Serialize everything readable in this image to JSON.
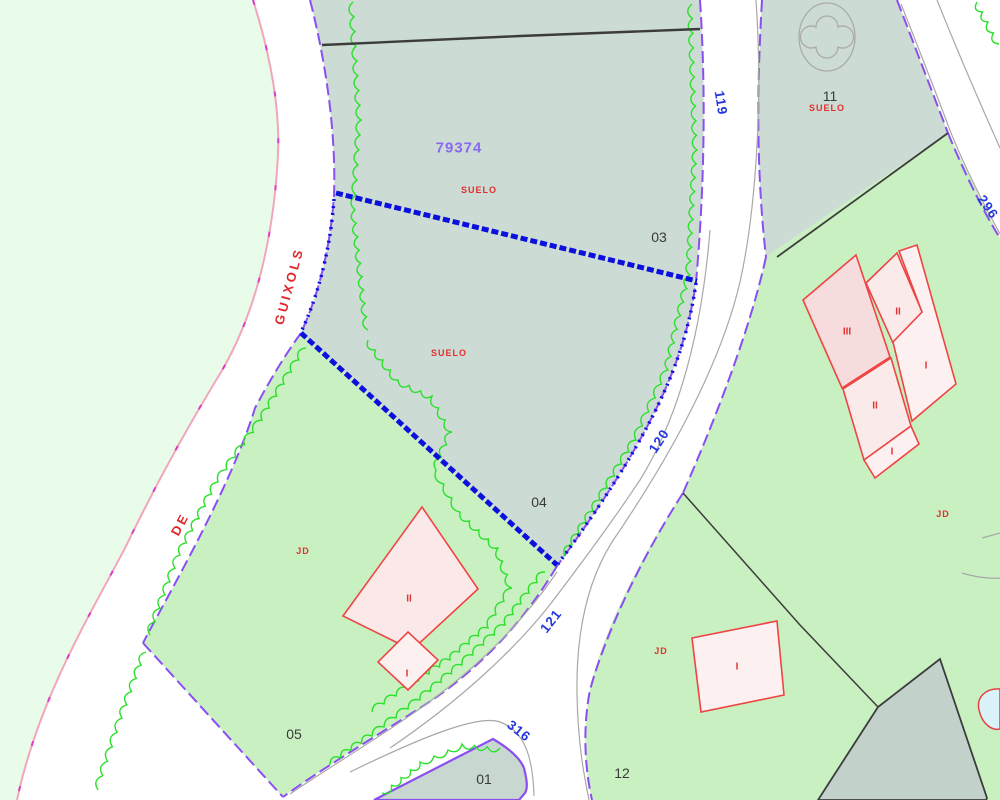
{
  "map": {
    "reference": "79374",
    "land_use_label": "SUELO",
    "street": {
      "name_line1": "DE",
      "name_line2": "GUIXOLS"
    },
    "parcels": {
      "p01": "01",
      "p03": "03",
      "p04": "04",
      "p05": "05",
      "p11": "11",
      "p12": "12"
    },
    "road_numbers": {
      "r119": "119",
      "r120": "120",
      "r121": "121",
      "r296": "296",
      "r316": "316"
    },
    "building_floors": {
      "one": "I",
      "two": "II",
      "three": "III"
    },
    "landscape_code": "JD",
    "colors": {
      "selection_blue": "#0b10dd",
      "parcel_edge_purple": "#8a4ff0",
      "road_edge_pink": "#f2a6ba",
      "road_edge_magenta": "#dc3cc8",
      "vegetation_green": "#2ce02c",
      "urban_teal_fill": "#ccdbd3",
      "rustic_green_fill": "#c9f0c1",
      "mint_fill": "#e9fbe9",
      "building_fill": "#fbe9e9",
      "building_edge_red": "#ef4444",
      "label_red": "#e03030",
      "label_blue": "#2438dd",
      "label_purple": "#8a68f2",
      "boundary_black": "#3c3c3c",
      "casing_gray": "#a8a8a8",
      "pool_blue": "#daf3f8"
    }
  }
}
